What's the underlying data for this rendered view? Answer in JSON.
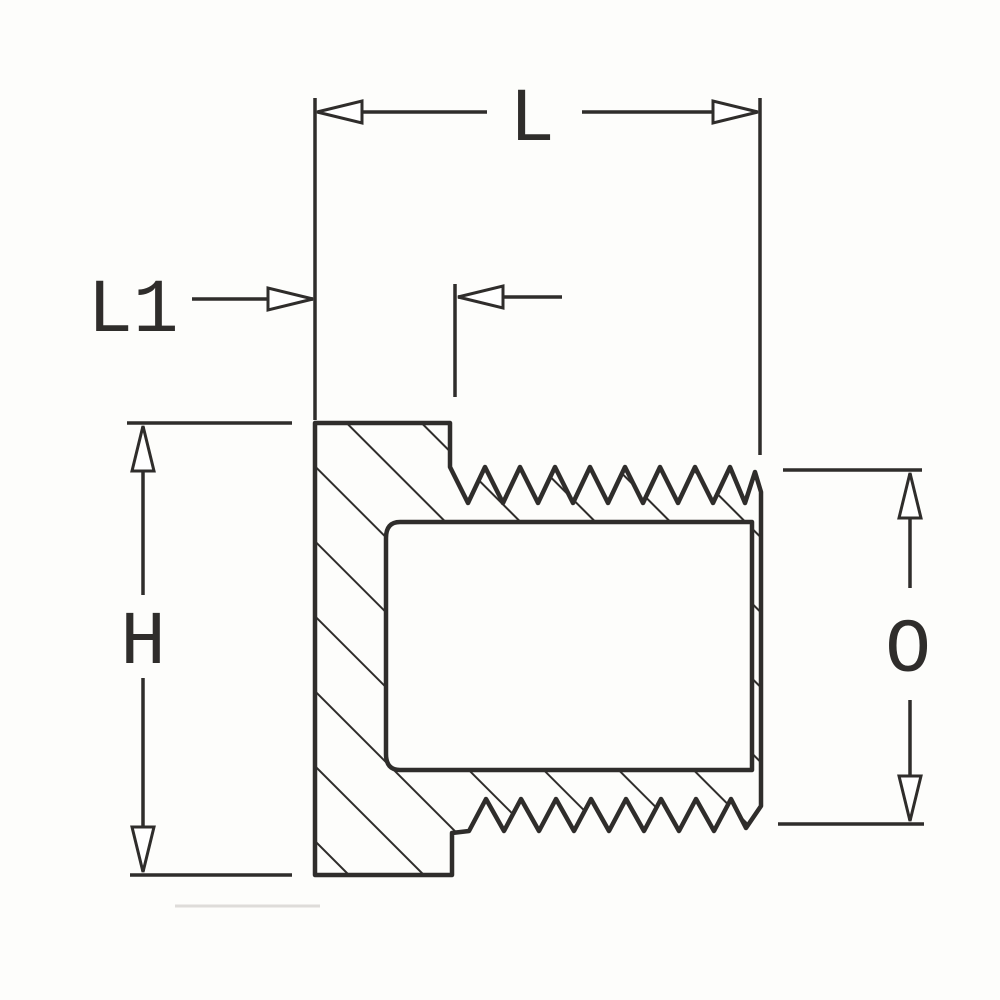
{
  "drawing": {
    "type": "engineering-section-drawing",
    "subject": "threaded hex-head pipe plug, cross-section with dimension callouts",
    "labels": {
      "length": "L",
      "thread_length": "L1",
      "height": "H",
      "diameter": "O"
    },
    "colors": {
      "line": "#2f2d2b",
      "background": "#fdfdfb",
      "arrow_fill": "#ffffff"
    }
  }
}
